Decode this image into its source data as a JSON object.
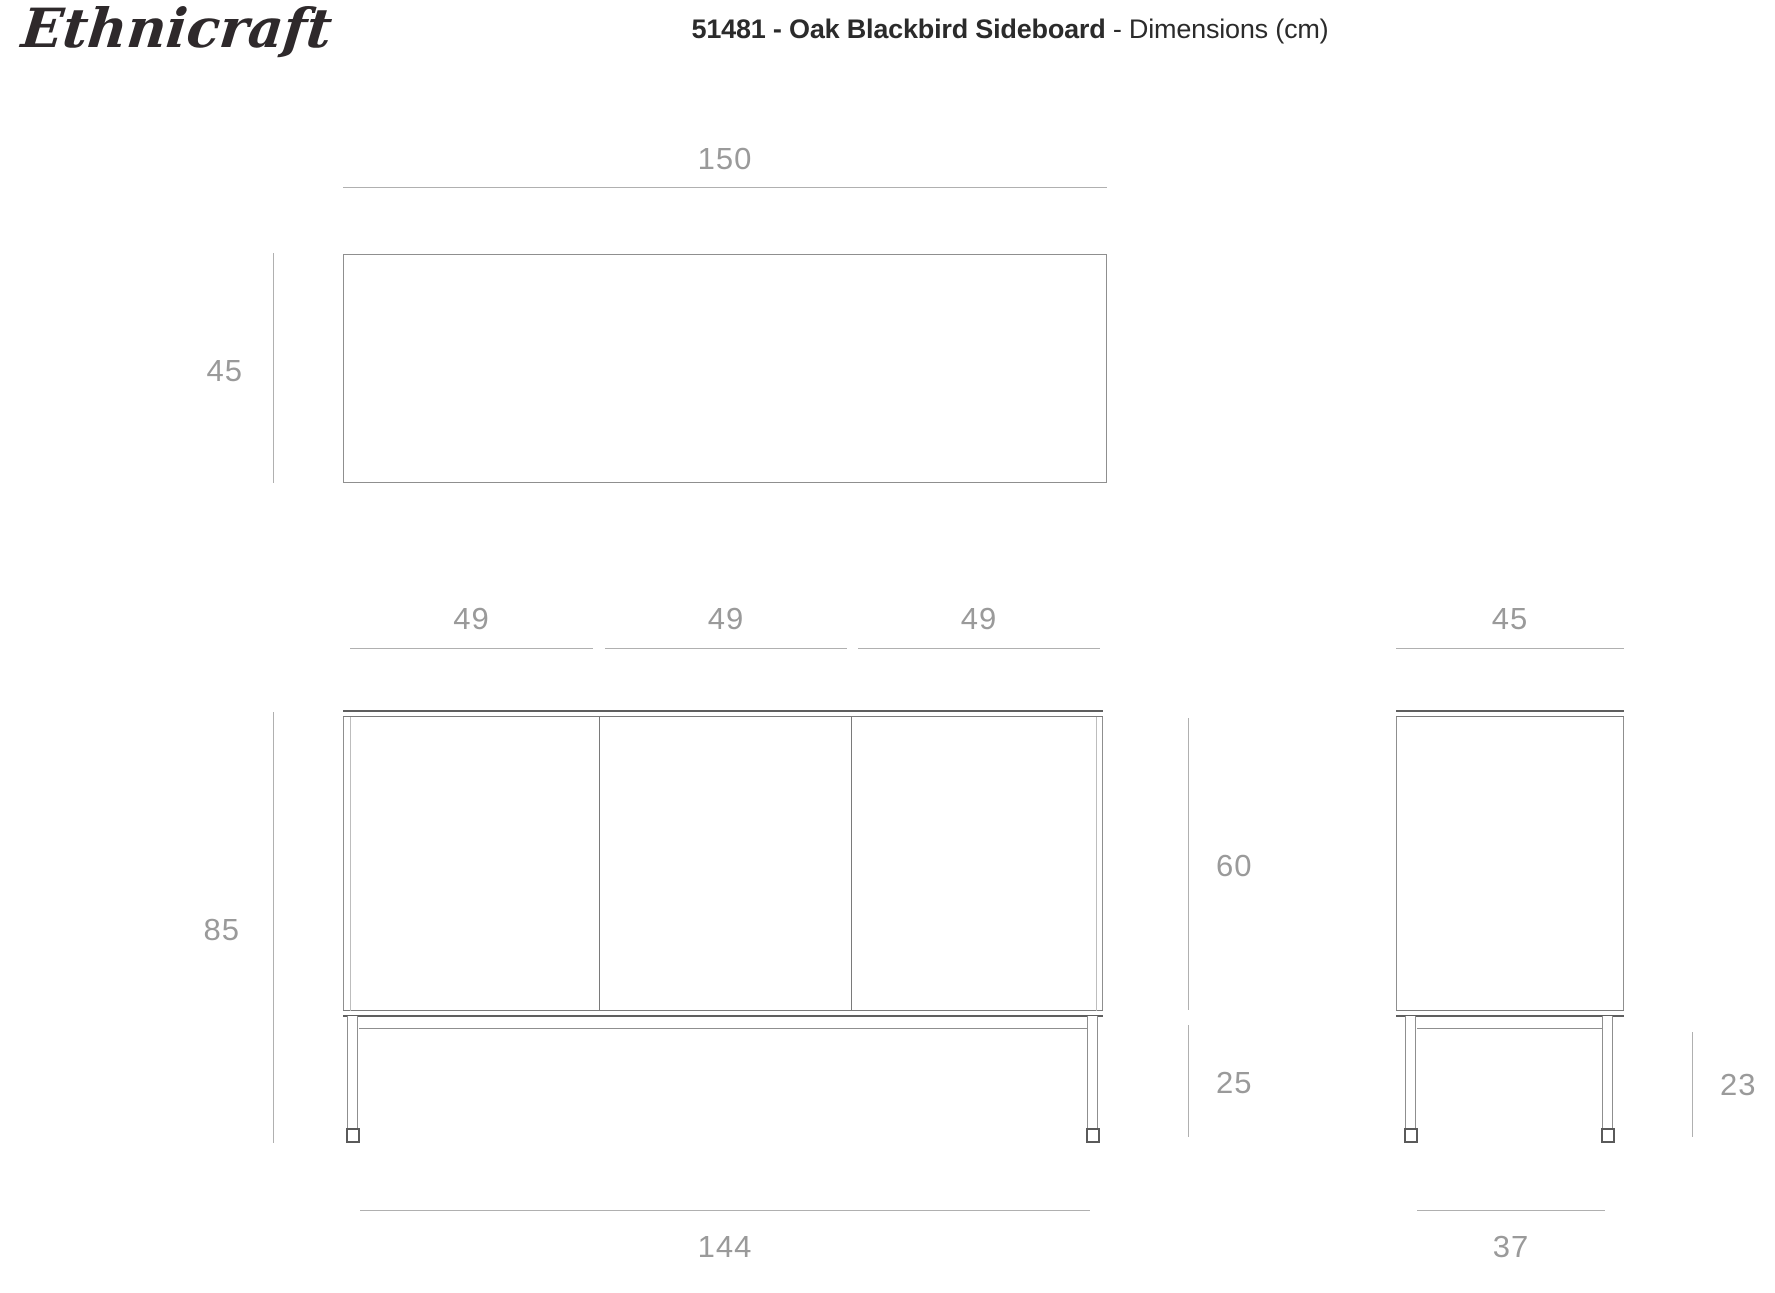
{
  "logo": {
    "text": "Ethnicraft"
  },
  "header": {
    "title_bold": "51481 - Oak Blackbird Sideboard",
    "title_rest": " - Dimensions (cm)"
  },
  "units": "cm",
  "views": {
    "top": {
      "label": "top-view",
      "width_label": "150",
      "depth_label": "45"
    },
    "front": {
      "label": "front-view",
      "door_labels": [
        "49",
        "49",
        "49"
      ],
      "total_height_label": "85",
      "body_height_label": "60",
      "leg_height_label": "25",
      "base_width_label": "144"
    },
    "side": {
      "label": "side-view",
      "depth_label": "45",
      "leg_height_label": "23",
      "base_depth_label": "37"
    }
  },
  "colors": {
    "background": "#ffffff",
    "title_text": "#2b2b2b",
    "logo_text": "#2e292b",
    "dimension_text": "#9a9a9a",
    "dimension_line": "#b0b0b0",
    "furniture_line": "#8f8f8f",
    "furniture_accent_line": "#5f5f5f"
  }
}
